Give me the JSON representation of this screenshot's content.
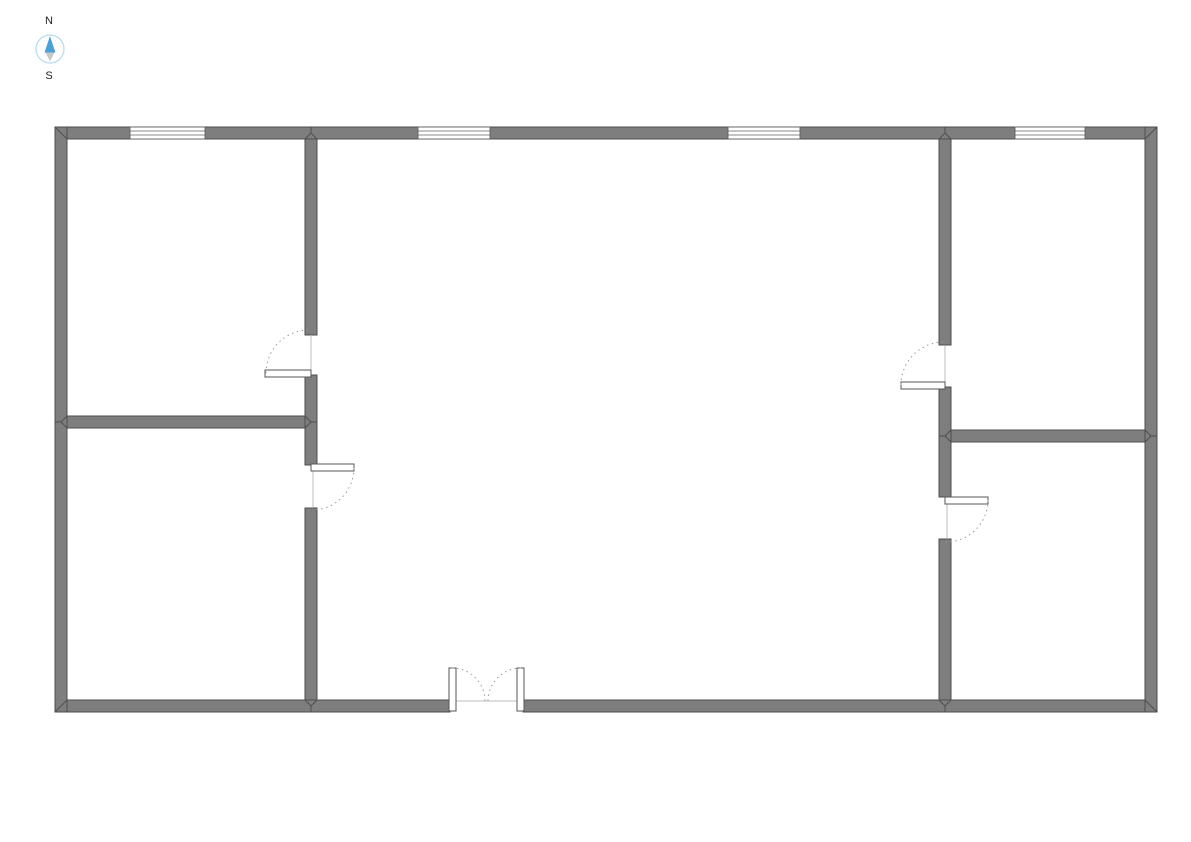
{
  "compass": {
    "north_label": "N",
    "south_label": "S",
    "ring_color": "#b7d9ec",
    "north_needle_color": "#4aa0d8",
    "south_needle_color": "#c9c9c9",
    "label_color": "#222222"
  },
  "floorplan": {
    "background": "#ffffff",
    "wall_fill": "#7e7e7e",
    "wall_stroke": "#4e4e4e",
    "opening_fill": "#ffffff",
    "window_frame_color": "#606060",
    "door_frame_color": "#555555",
    "swing_arc_color": "#9a9a9a",
    "threshold_color": "#bdbdbd",
    "walls": [
      {
        "name": "exterior-wall-top",
        "x": 55,
        "y": 127,
        "w": 1102,
        "h": 12
      },
      {
        "name": "exterior-wall-bottom-west",
        "x": 55,
        "y": 700,
        "w": 395,
        "h": 12
      },
      {
        "name": "exterior-wall-bottom-east",
        "x": 523,
        "y": 700,
        "w": 634,
        "h": 12
      },
      {
        "name": "exterior-wall-left",
        "x": 55,
        "y": 127,
        "w": 12,
        "h": 585
      },
      {
        "name": "exterior-wall-right",
        "x": 1145,
        "y": 127,
        "w": 12,
        "h": 585
      },
      {
        "name": "interior-wall-west-upper",
        "x": 305,
        "y": 139,
        "w": 12,
        "h": 196
      },
      {
        "name": "interior-wall-west-middle",
        "x": 305,
        "y": 375,
        "w": 12,
        "h": 90
      },
      {
        "name": "interior-wall-west-lower",
        "x": 305,
        "y": 508,
        "w": 12,
        "h": 192
      },
      {
        "name": "interior-wall-east-upper",
        "x": 939,
        "y": 139,
        "w": 12,
        "h": 206
      },
      {
        "name": "interior-wall-east-middle",
        "x": 939,
        "y": 387,
        "w": 12,
        "h": 110
      },
      {
        "name": "interior-wall-east-lower",
        "x": 939,
        "y": 539,
        "w": 12,
        "h": 161
      },
      {
        "name": "interior-wall-northwest-room-south",
        "x": 67,
        "y": 416,
        "w": 238,
        "h": 12
      },
      {
        "name": "interior-wall-northeast-room-south",
        "x": 951,
        "y": 430,
        "w": 194,
        "h": 12
      }
    ],
    "windows": [
      {
        "name": "window-northwest",
        "x": 130,
        "y": 127,
        "w": 75,
        "h": 12
      },
      {
        "name": "window-north-center-west",
        "x": 418,
        "y": 127,
        "w": 72,
        "h": 12
      },
      {
        "name": "window-north-center-east",
        "x": 728,
        "y": 127,
        "w": 72,
        "h": 12
      },
      {
        "name": "window-northeast",
        "x": 1015,
        "y": 127,
        "w": 70,
        "h": 12
      }
    ],
    "door_leaves": [
      {
        "name": "door-leaf-northwest-room",
        "x": 265,
        "y": 370,
        "w": 46,
        "h": 7
      },
      {
        "name": "door-leaf-southwest-room",
        "x": 311,
        "y": 464,
        "w": 43,
        "h": 7
      },
      {
        "name": "door-leaf-northeast-room",
        "x": 901,
        "y": 382,
        "w": 44,
        "h": 7
      },
      {
        "name": "door-leaf-southeast-room",
        "x": 945,
        "y": 497,
        "w": 43,
        "h": 7
      },
      {
        "name": "double-door-leaf-west",
        "x": 449,
        "y": 668,
        "w": 7,
        "h": 43
      },
      {
        "name": "double-door-leaf-east",
        "x": 517,
        "y": 668,
        "w": 7,
        "h": 43
      }
    ],
    "door_swings": [
      {
        "name": "door-swing-northwest-room",
        "d": "M266,373 A43,43 0 0 1 309,330"
      },
      {
        "name": "door-swing-southwest-room",
        "d": "M354,468 A42,42 0 0 1 312,510"
      },
      {
        "name": "door-swing-northeast-room",
        "d": "M901,385 A43,43 0 0 1 944,342"
      },
      {
        "name": "door-swing-southeast-room",
        "d": "M988,500 A42,42 0 0 1 946,542"
      },
      {
        "name": "double-door-swing-west",
        "d": "M452,668 A33,33 0 0 1 485,701"
      },
      {
        "name": "double-door-swing-east",
        "d": "M521,668 A33,33 0 0 0 488,701"
      }
    ],
    "door_thresholds": [
      {
        "name": "door-threshold-northwest-room",
        "x1": 311,
        "y1": 335,
        "x2": 311,
        "y2": 370
      },
      {
        "name": "door-threshold-southwest-room",
        "x1": 313,
        "y1": 471,
        "x2": 313,
        "y2": 507
      },
      {
        "name": "door-threshold-northeast-room",
        "x1": 945,
        "y1": 346,
        "x2": 945,
        "y2": 382
      },
      {
        "name": "door-threshold-southeast-room",
        "x1": 947,
        "y1": 504,
        "x2": 947,
        "y2": 538
      },
      {
        "name": "double-door-threshold",
        "x1": 456,
        "y1": 701,
        "x2": 517,
        "y2": 701
      }
    ],
    "wall_seams": [
      {
        "x1": 55,
        "y1": 127,
        "x2": 67,
        "y2": 139
      },
      {
        "x1": 1157,
        "y1": 127,
        "x2": 1145,
        "y2": 139
      },
      {
        "x1": 55,
        "y1": 712,
        "x2": 67,
        "y2": 700
      },
      {
        "x1": 1157,
        "y1": 712,
        "x2": 1145,
        "y2": 700
      },
      {
        "x1": 305,
        "y1": 139,
        "x2": 311,
        "y2": 133
      },
      {
        "x1": 317,
        "y1": 139,
        "x2": 311,
        "y2": 133
      },
      {
        "x1": 311,
        "y1": 133,
        "x2": 311,
        "y2": 127
      },
      {
        "x1": 939,
        "y1": 139,
        "x2": 945,
        "y2": 133
      },
      {
        "x1": 951,
        "y1": 139,
        "x2": 945,
        "y2": 133
      },
      {
        "x1": 945,
        "y1": 133,
        "x2": 945,
        "y2": 127
      },
      {
        "x1": 305,
        "y1": 700,
        "x2": 311,
        "y2": 706
      },
      {
        "x1": 317,
        "y1": 700,
        "x2": 311,
        "y2": 706
      },
      {
        "x1": 311,
        "y1": 706,
        "x2": 311,
        "y2": 712
      },
      {
        "x1": 939,
        "y1": 700,
        "x2": 945,
        "y2": 706
      },
      {
        "x1": 951,
        "y1": 700,
        "x2": 945,
        "y2": 706
      },
      {
        "x1": 945,
        "y1": 706,
        "x2": 945,
        "y2": 712
      },
      {
        "x1": 67,
        "y1": 416,
        "x2": 61,
        "y2": 422
      },
      {
        "x1": 67,
        "y1": 428,
        "x2": 61,
        "y2": 422
      },
      {
        "x1": 61,
        "y1": 422,
        "x2": 55,
        "y2": 422
      },
      {
        "x1": 305,
        "y1": 416,
        "x2": 311,
        "y2": 422
      },
      {
        "x1": 305,
        "y1": 428,
        "x2": 311,
        "y2": 422
      },
      {
        "x1": 311,
        "y1": 422,
        "x2": 317,
        "y2": 422
      },
      {
        "x1": 951,
        "y1": 430,
        "x2": 945,
        "y2": 436
      },
      {
        "x1": 951,
        "y1": 442,
        "x2": 945,
        "y2": 436
      },
      {
        "x1": 945,
        "y1": 436,
        "x2": 939,
        "y2": 436
      },
      {
        "x1": 1145,
        "y1": 430,
        "x2": 1151,
        "y2": 436
      },
      {
        "x1": 1145,
        "y1": 442,
        "x2": 1151,
        "y2": 436
      },
      {
        "x1": 1151,
        "y1": 436,
        "x2": 1157,
        "y2": 436
      }
    ]
  }
}
